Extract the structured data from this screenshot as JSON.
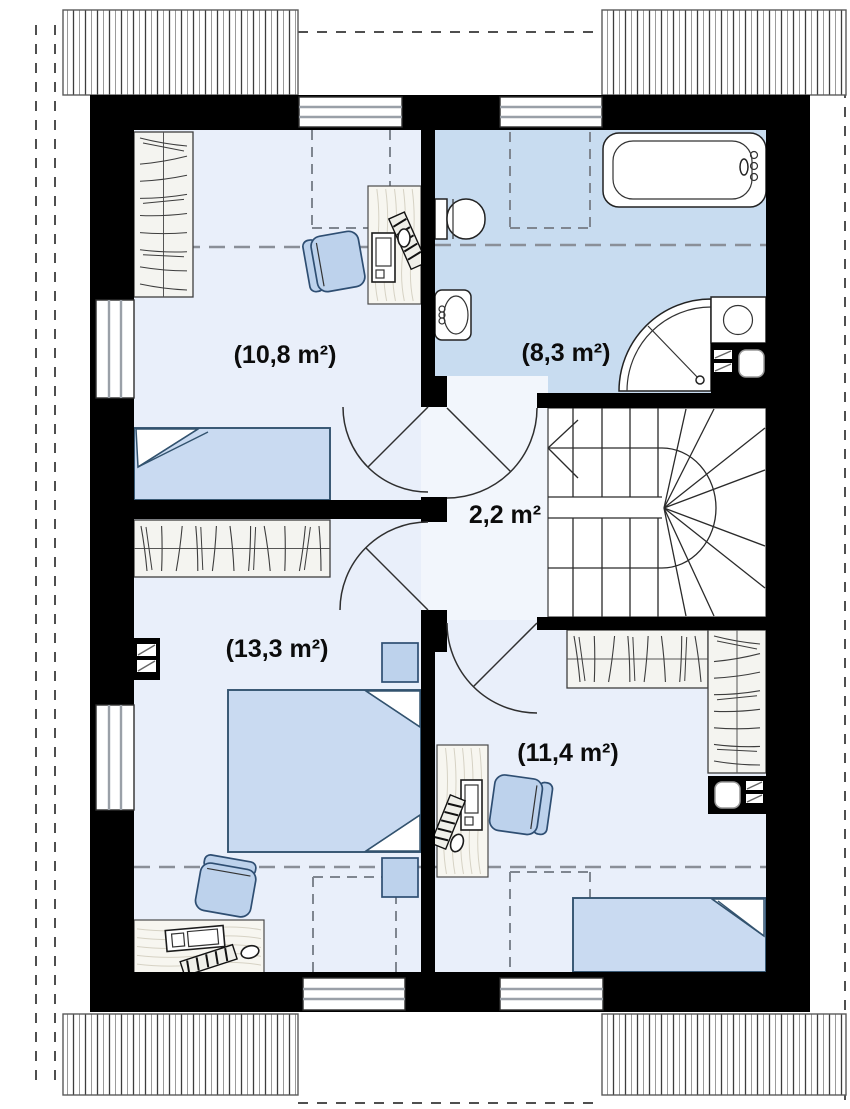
{
  "plan": {
    "type": "attic-floor-plan",
    "rooms": [
      {
        "id": "bedroom-top-left",
        "area_label": "(10,8 m²)"
      },
      {
        "id": "bathroom",
        "area_label": "(8,3 m²)"
      },
      {
        "id": "hallway",
        "area_label": "2,2 m²"
      },
      {
        "id": "bedroom-bottom-left",
        "area_label": "(13,3 m²)"
      },
      {
        "id": "bedroom-bottom-right",
        "area_label": "(11,4 m²)"
      }
    ]
  },
  "colors": {
    "wall": "#000000",
    "roomFloor": "#e9effa",
    "bathFloor": "#c8dcf0",
    "hallFloor": "#f2f6fc",
    "furn": "#bdd2ec",
    "bed": "#c9daf1",
    "wood": "#f7f6f0",
    "dash": "#8a8f98"
  }
}
